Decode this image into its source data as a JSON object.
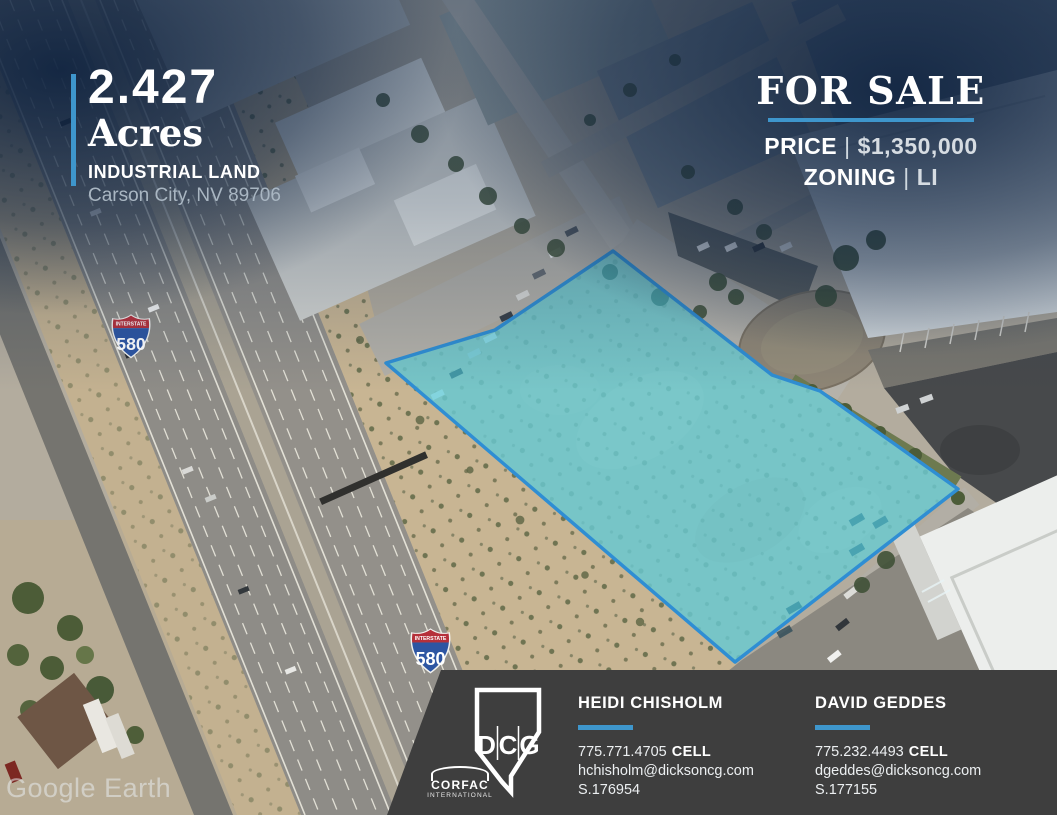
{
  "property": {
    "acreage": "2.427",
    "unit": "Acres",
    "type": "INDUSTRIAL LAND",
    "location": "Carson City, NV 89706"
  },
  "sale": {
    "headline": "FOR SALE",
    "price_label": "PRICE",
    "separator": "|",
    "price_value": "$1,350,000",
    "zoning_label": "ZONING",
    "zoning_value": "LI"
  },
  "map": {
    "watermark": "Google Earth",
    "shields": [
      {
        "label": "INTERSTATE",
        "number": "580"
      },
      {
        "label": "INTERSTATE",
        "number": "580"
      }
    ],
    "parcel": {
      "fill": "#46c8da",
      "stroke": "#2f8ed3"
    }
  },
  "footer": {
    "logo": {
      "letters": [
        "D",
        "C",
        "G"
      ],
      "corfac": "CORFAC",
      "corfac_sub": "INTERNATIONAL"
    },
    "agents": [
      {
        "name": "HEIDI CHISHOLM",
        "phone": "775.771.4705",
        "phone_label": "CELL",
        "email": "hchisholm@dicksoncg.com",
        "license": "S.176954"
      },
      {
        "name": "DAVID GEDDES",
        "phone": "775.232.4493",
        "phone_label": "CELL",
        "email": "dgeddes@dicksoncg.com",
        "license": "S.177155"
      }
    ]
  },
  "colors": {
    "accent": "#3e96cc",
    "panel": "#3e3e3e"
  }
}
